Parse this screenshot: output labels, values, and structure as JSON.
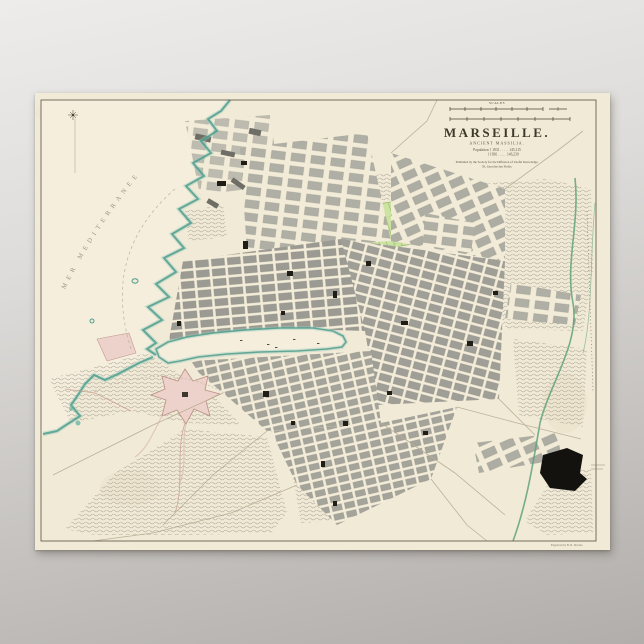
{
  "scene": {
    "background_top": "#edecea",
    "background_bottom": "#b1aeab"
  },
  "poster": {
    "paper_color": "#f1ead6",
    "frame_color": "#6b6254"
  },
  "map": {
    "scales_label": "SCALES",
    "title": "MARSEILLE.",
    "subtitle": "ANCIENT MASSILIA.",
    "population_line_1": "Population { 1831 . . . . . 145,115",
    "population_line_2": "{ 1836 . . . . . 146,239",
    "publisher_line_1": "Published by the Society for the Diffusion of Useful Knowledge.",
    "publisher_line_2": "59, Lincolns Inn Fields.",
    "sea_label": "MER MEDITERRANEE",
    "credit": "Engraved by B. R. Davies.",
    "colors": {
      "sea": "#f5eedd",
      "coast": "#4f9e8e",
      "blocks": "#9c9b93",
      "park": "#cde3a2",
      "fort": "#ecd2ca",
      "hills": "#a9a396",
      "stream": "#5fa27c",
      "cemetery": "#14120f",
      "ink": "#4a4436"
    }
  }
}
